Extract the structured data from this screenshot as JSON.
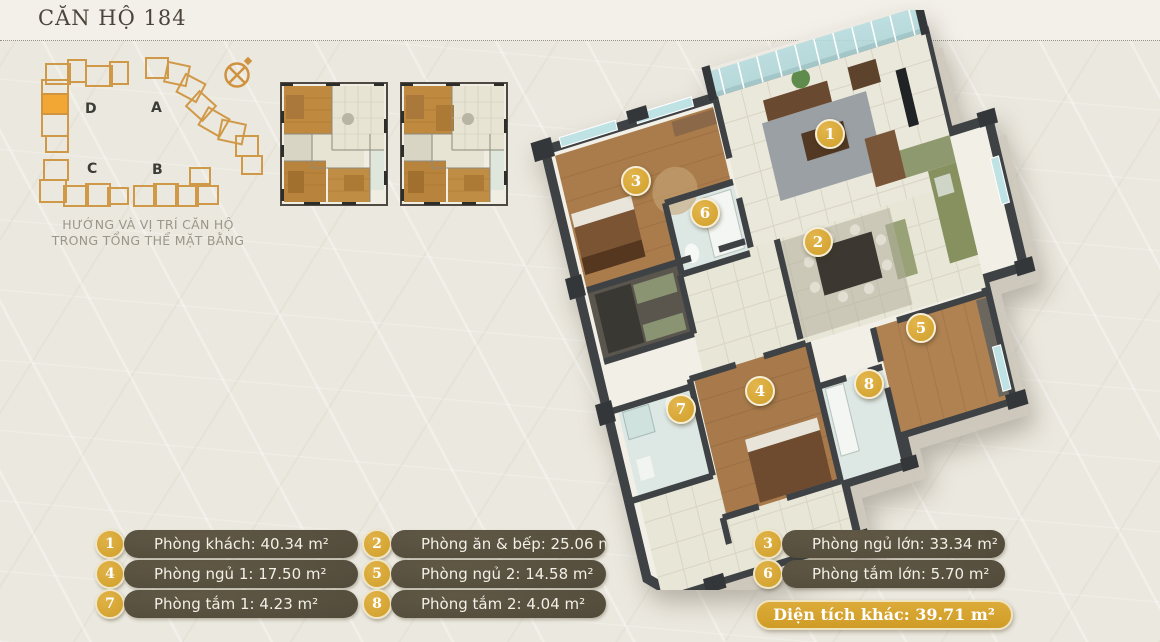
{
  "page": {
    "title": "CĂN HỘ 184"
  },
  "site_plan": {
    "caption_line1": "HƯỚNG VÀ VỊ TRÍ CĂN HỘ",
    "caption_line2": "TRONG TỔNG THỂ MẶT BẰNG",
    "buildings": [
      {
        "label": "D"
      },
      {
        "label": "A"
      },
      {
        "label": "C"
      },
      {
        "label": "B"
      }
    ],
    "outline_color": "#cf9540",
    "highlight_color": "#f2a633"
  },
  "plan_markers": [
    "1",
    "2",
    "3",
    "4",
    "5",
    "6",
    "7",
    "8"
  ],
  "legend": {
    "items": [
      {
        "num": "1",
        "label": "Phòng khách: 40.34 m²"
      },
      {
        "num": "2",
        "label": "Phòng ăn & bếp: 25.06 m²"
      },
      {
        "num": "3",
        "label": "Phòng ngủ lớn: 33.34 m²"
      },
      {
        "num": "4",
        "label": "Phòng ngủ 1: 17.50 m²"
      },
      {
        "num": "5",
        "label": "Phòng ngủ 2: 14.58 m²"
      },
      {
        "num": "6",
        "label": "Phòng tắm lớn: 5.70 m²"
      },
      {
        "num": "7",
        "label": "Phòng tắm 1: 4.23 m²"
      },
      {
        "num": "8",
        "label": "Phòng tắm 2: 4.04 m²"
      }
    ],
    "other_area_label": "Diện tích khác: 39.71 m²",
    "marker_color": "#d1a02b",
    "pill_color": "#57503f"
  }
}
